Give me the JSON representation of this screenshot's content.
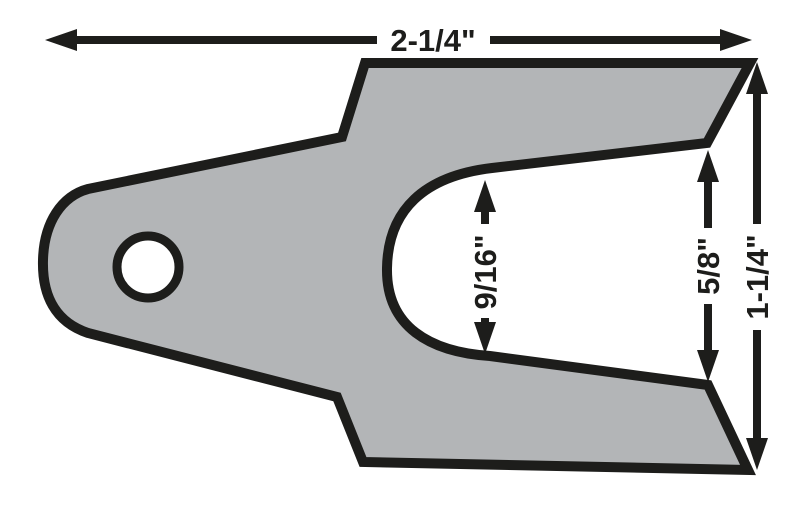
{
  "colors": {
    "part_fill": "#b3b5b7",
    "line_color": "#1d1d1b",
    "background": "#ffffff"
  },
  "dimensions": {
    "overall_width": {
      "label": "2-1/4\""
    },
    "slot_height": {
      "label": "9/16\""
    },
    "fork_opening": {
      "label": "5/8\""
    },
    "overall_height": {
      "label": "1-1/4\""
    }
  }
}
